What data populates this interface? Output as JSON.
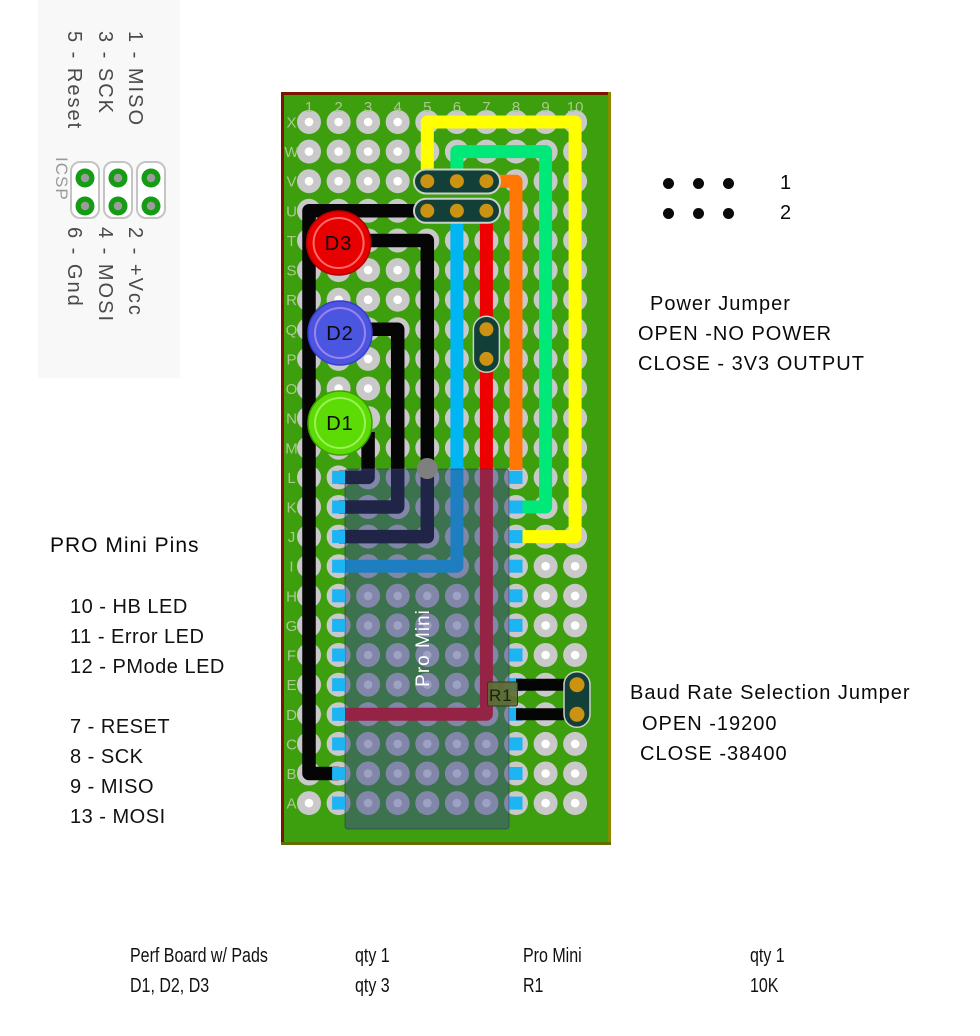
{
  "colors": {
    "board_green": "#3D9E0E",
    "board_border_top": "#7A1500",
    "board_border_right": "#8A8A00",
    "board_border_bottom": "#5E7000",
    "pad_gray": "#C9C9C9",
    "board_label": "#A8CB8C",
    "wire_yellow": "#FFFF00",
    "wire_green": "#00E878",
    "wire_orange": "#FF7704",
    "wire_cyan": "#00B6F2",
    "wire_red": "#EE0000",
    "wire_black": "#050505",
    "header_teal": "#123F38",
    "header_pad_gold": "#CC9211",
    "overlay_blue": "rgba(60,70,140,0.5)",
    "pin_blue": "#1CB4F2",
    "led_d3_red": "#E60000",
    "led_d2_blue": "#4A55E0",
    "led_d1_green": "#5CDC04",
    "resistor_body": "#5F6D35",
    "icsp_pad_green": "#149C14",
    "wire_cap_gray": "#7F7F7F"
  },
  "icsp": {
    "label": "ICSP",
    "top_pins": [
      "1 - MISO",
      "3 - SCK",
      "5 - Reset"
    ],
    "bottom_pins": [
      "2 - +Vcc",
      "4 - MOSI",
      "6 - Gnd"
    ]
  },
  "board": {
    "col_labels": [
      "1",
      "2",
      "3",
      "4",
      "5",
      "6",
      "7",
      "8",
      "9",
      "10"
    ],
    "row_labels": [
      "X",
      "W",
      "V",
      "U",
      "T",
      "S",
      "R",
      "Q",
      "P",
      "O",
      "N",
      "M",
      "L",
      "K",
      "J",
      "I",
      "H",
      "G",
      "F",
      "E",
      "D",
      "C",
      "B",
      "A"
    ],
    "leds": [
      {
        "label": "D3"
      },
      {
        "label": "D2"
      },
      {
        "label": "D1"
      }
    ],
    "pro_mini_label": "Pro Mini",
    "resistor_label": "R1"
  },
  "power_jumper": {
    "pin_row_labels": [
      "1",
      "2"
    ],
    "title": "Power Jumper",
    "line1": "OPEN -NO POWER",
    "line2": "CLOSE - 3V3 OUTPUT"
  },
  "pro_mini_pins": {
    "title": "PRO Mini Pins",
    "group1": [
      "10 - HB LED",
      "11 - Error LED",
      "12 - PMode LED"
    ],
    "group2": [
      "7 - RESET",
      "8 - SCK",
      "9 - MISO",
      "13 - MOSI"
    ]
  },
  "baud_jumper": {
    "title": "Baud Rate Selection Jumper",
    "line1": "OPEN -19200",
    "line2": "CLOSE -38400"
  },
  "parts_list": {
    "rows": [
      [
        "Perf Board w/ Pads",
        "qty 1",
        "Pro Mini",
        "qty 1"
      ],
      [
        "D1, D2, D3",
        "qty 3",
        "R1",
        "10K"
      ]
    ]
  }
}
